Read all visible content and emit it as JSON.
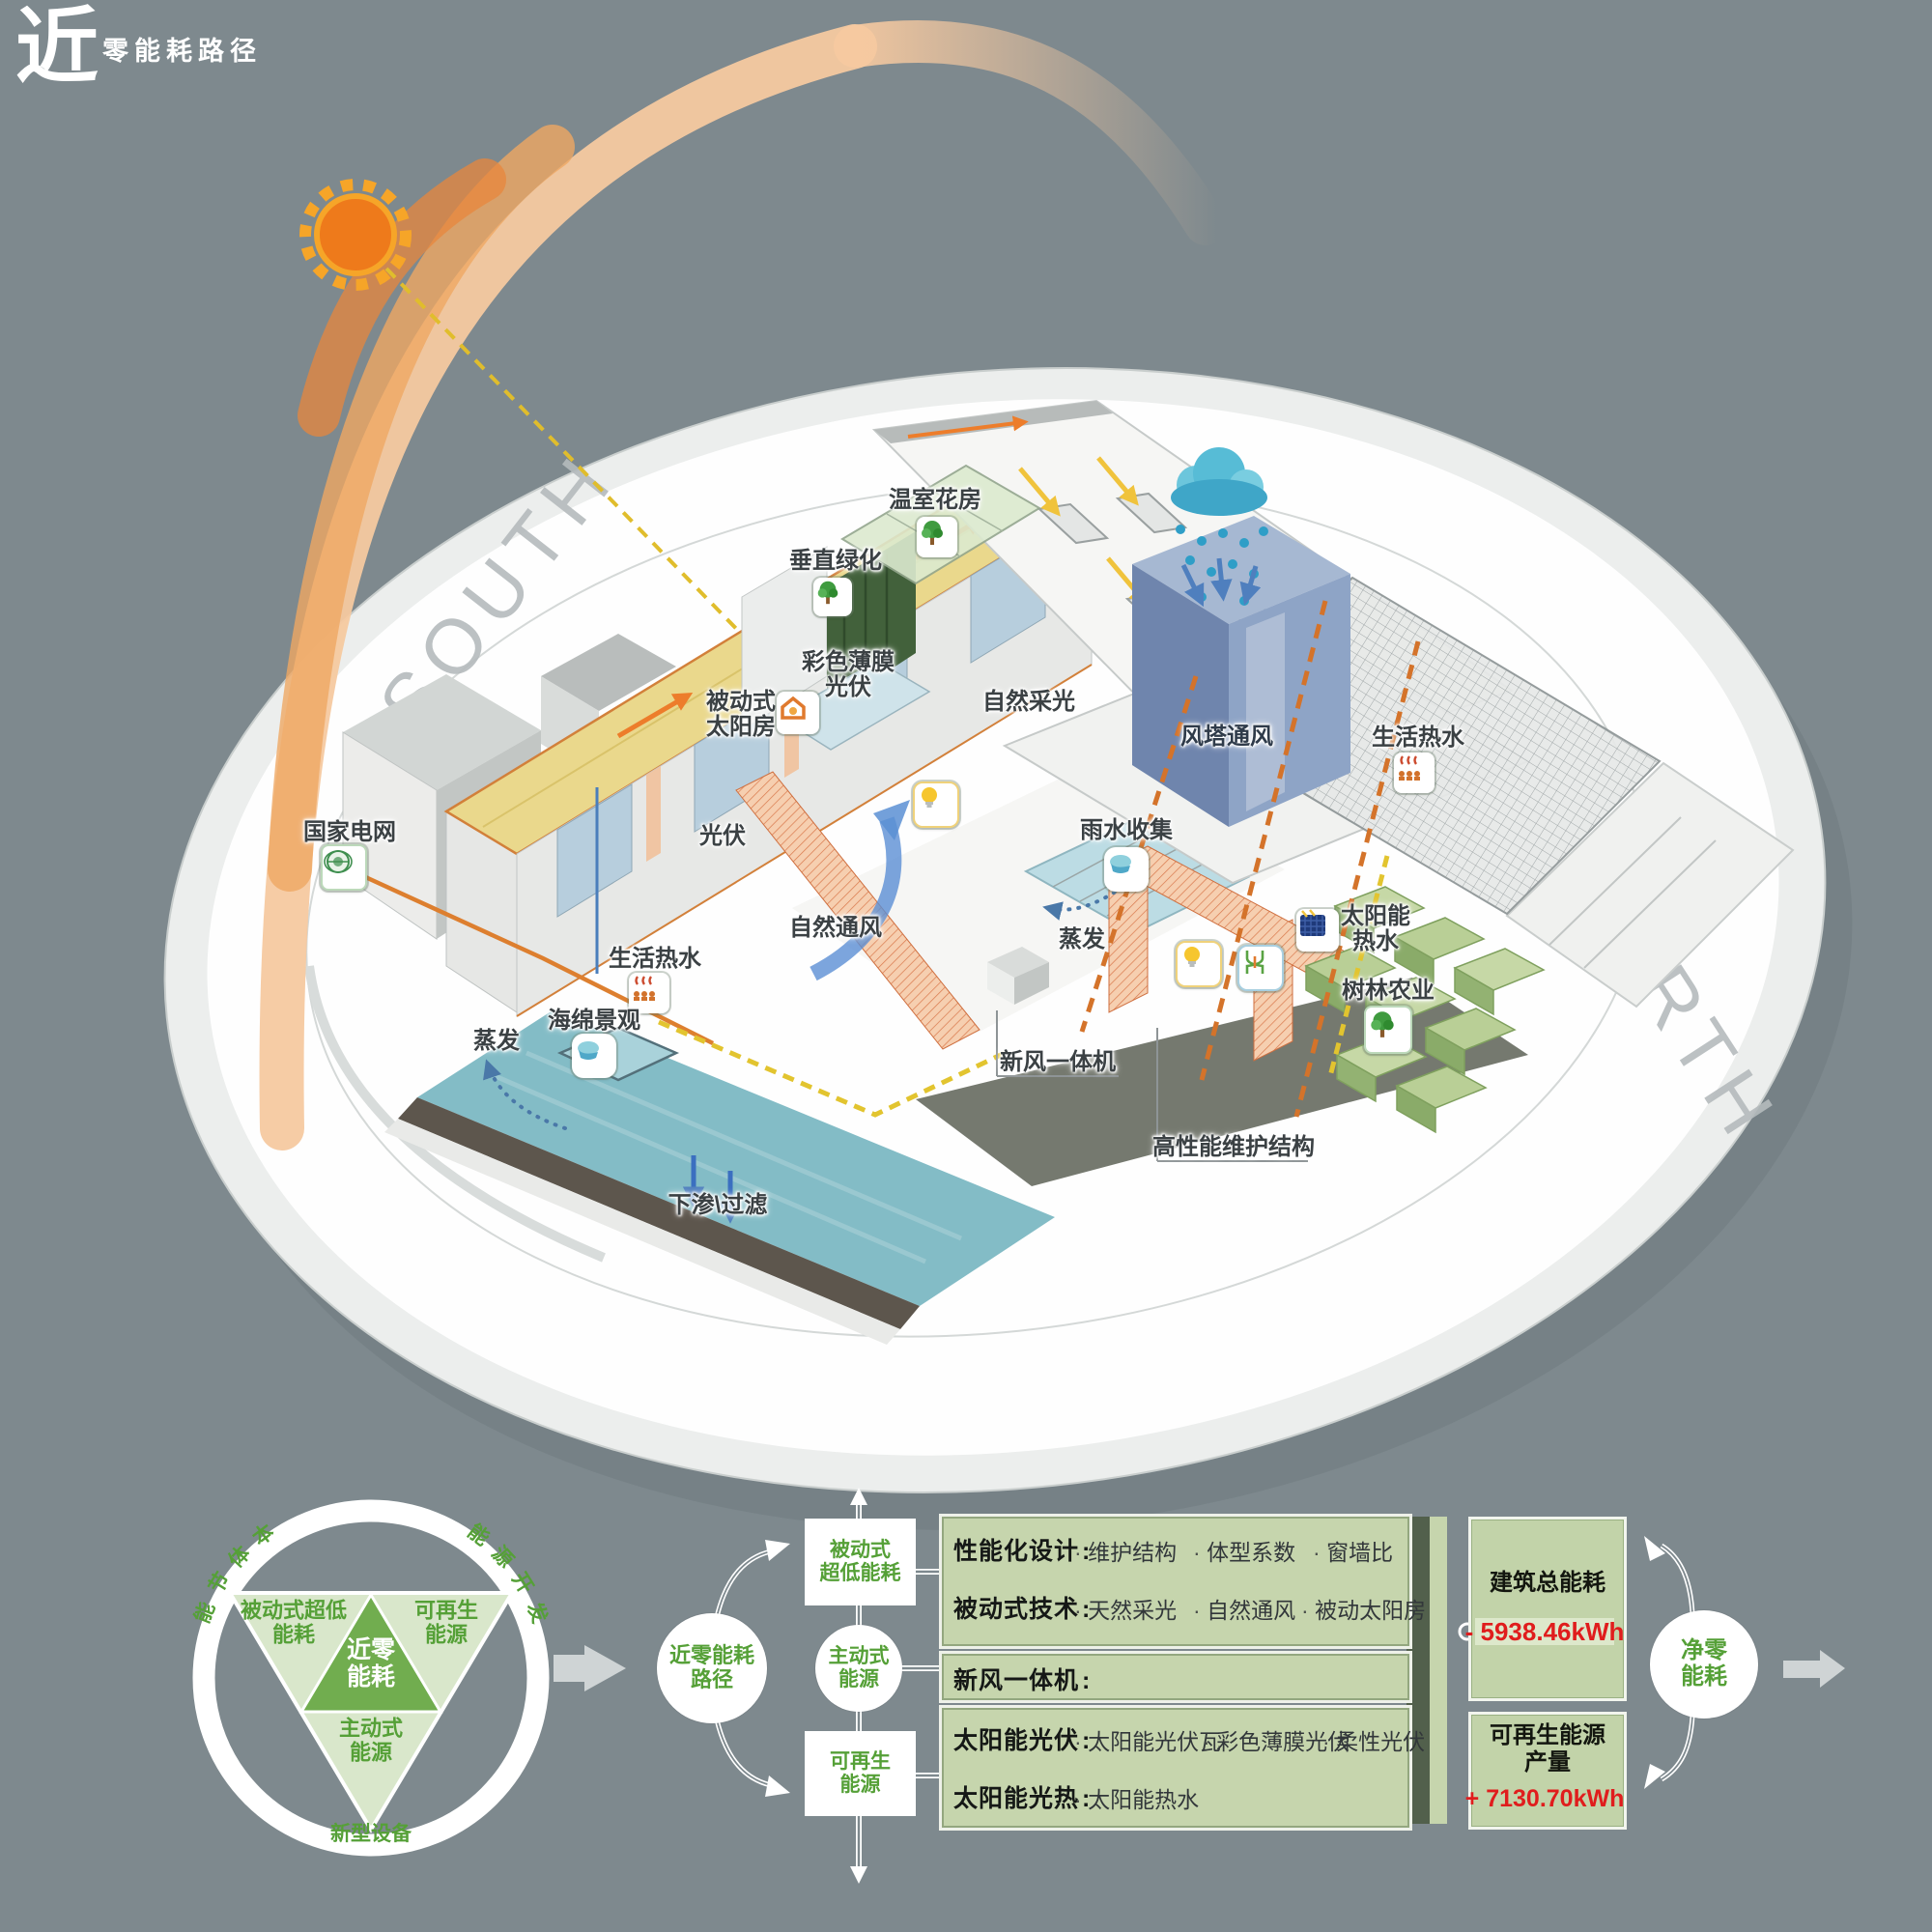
{
  "logo": {
    "big": "近",
    "rest": "零能耗路径"
  },
  "compass": {
    "south": "SOUTH",
    "north": "NORTH"
  },
  "labels": {
    "greenhouse": "温室花房",
    "vertical_green": "垂直绿化",
    "film_pv_1": "彩色薄膜",
    "film_pv_2": "光伏",
    "passive_solar_1": "被动式",
    "passive_solar_2": "太阳房",
    "daylight": "自然采光",
    "wind_tower": "风塔通风",
    "hot_water_r": "生活热水",
    "rain_collect": "雨水收集",
    "evap_c": "蒸发",
    "pv": "光伏",
    "nat_vent": "自然通风",
    "hot_water_l": "生活热水",
    "grid": "国家电网",
    "solar_hw_1": "太阳能",
    "solar_hw_2": "热水",
    "forest": "树林农业",
    "sponge": "海绵景观",
    "evap_l": "蒸发",
    "ahu": "新风一体机",
    "envelope": "高性能维护结构",
    "infiltrate": "下渗\\过滤"
  },
  "venn": {
    "arc_left": "本体节能",
    "arc_right": "能源开发",
    "arc_bottom": "新型设备",
    "left_1": "被动式超低",
    "left_2": "能耗",
    "right_1": "可再生",
    "right_2": "能源",
    "bottom_1": "主动式",
    "bottom_2": "能源",
    "center_1": "近零",
    "center_2": "能耗"
  },
  "flow": {
    "hub_1": "近零能耗",
    "hub_2": "路径",
    "passive_1": "被动式",
    "passive_2": "超低能耗",
    "active_1": "主动式",
    "active_2": "能源",
    "renewable_1": "可再生",
    "renewable_2": "能源"
  },
  "panels": {
    "row1": {
      "l1": "性能化设计",
      "items1": [
        "维护结构",
        "体型系数",
        "窗墙比"
      ],
      "l2": "被动式技术",
      "items2": [
        "天然采光",
        "自然通风",
        "被动太阳房"
      ]
    },
    "row2": {
      "l1": "新风一体机"
    },
    "row3": {
      "l1": "太阳能光伏",
      "items1": [
        "太阳能光伏瓦",
        "彩色薄膜光伏",
        "柔性光伏"
      ],
      "l2": "太阳能光热",
      "items2": [
        "太阳能热水"
      ]
    }
  },
  "outputs": {
    "total_title": "建筑总能耗",
    "total_value": "- 5938.46kWh",
    "renew_title_1": "可再生能源",
    "renew_title_2": "产量",
    "renew_value": "+ 7130.70kWh",
    "net_1": "净零",
    "net_2": "能耗"
  },
  "colors": {
    "accent_orange": "#ed7d31",
    "accent_green": "#55a037",
    "value_red": "#e01d1d",
    "background": "#7e898e"
  }
}
